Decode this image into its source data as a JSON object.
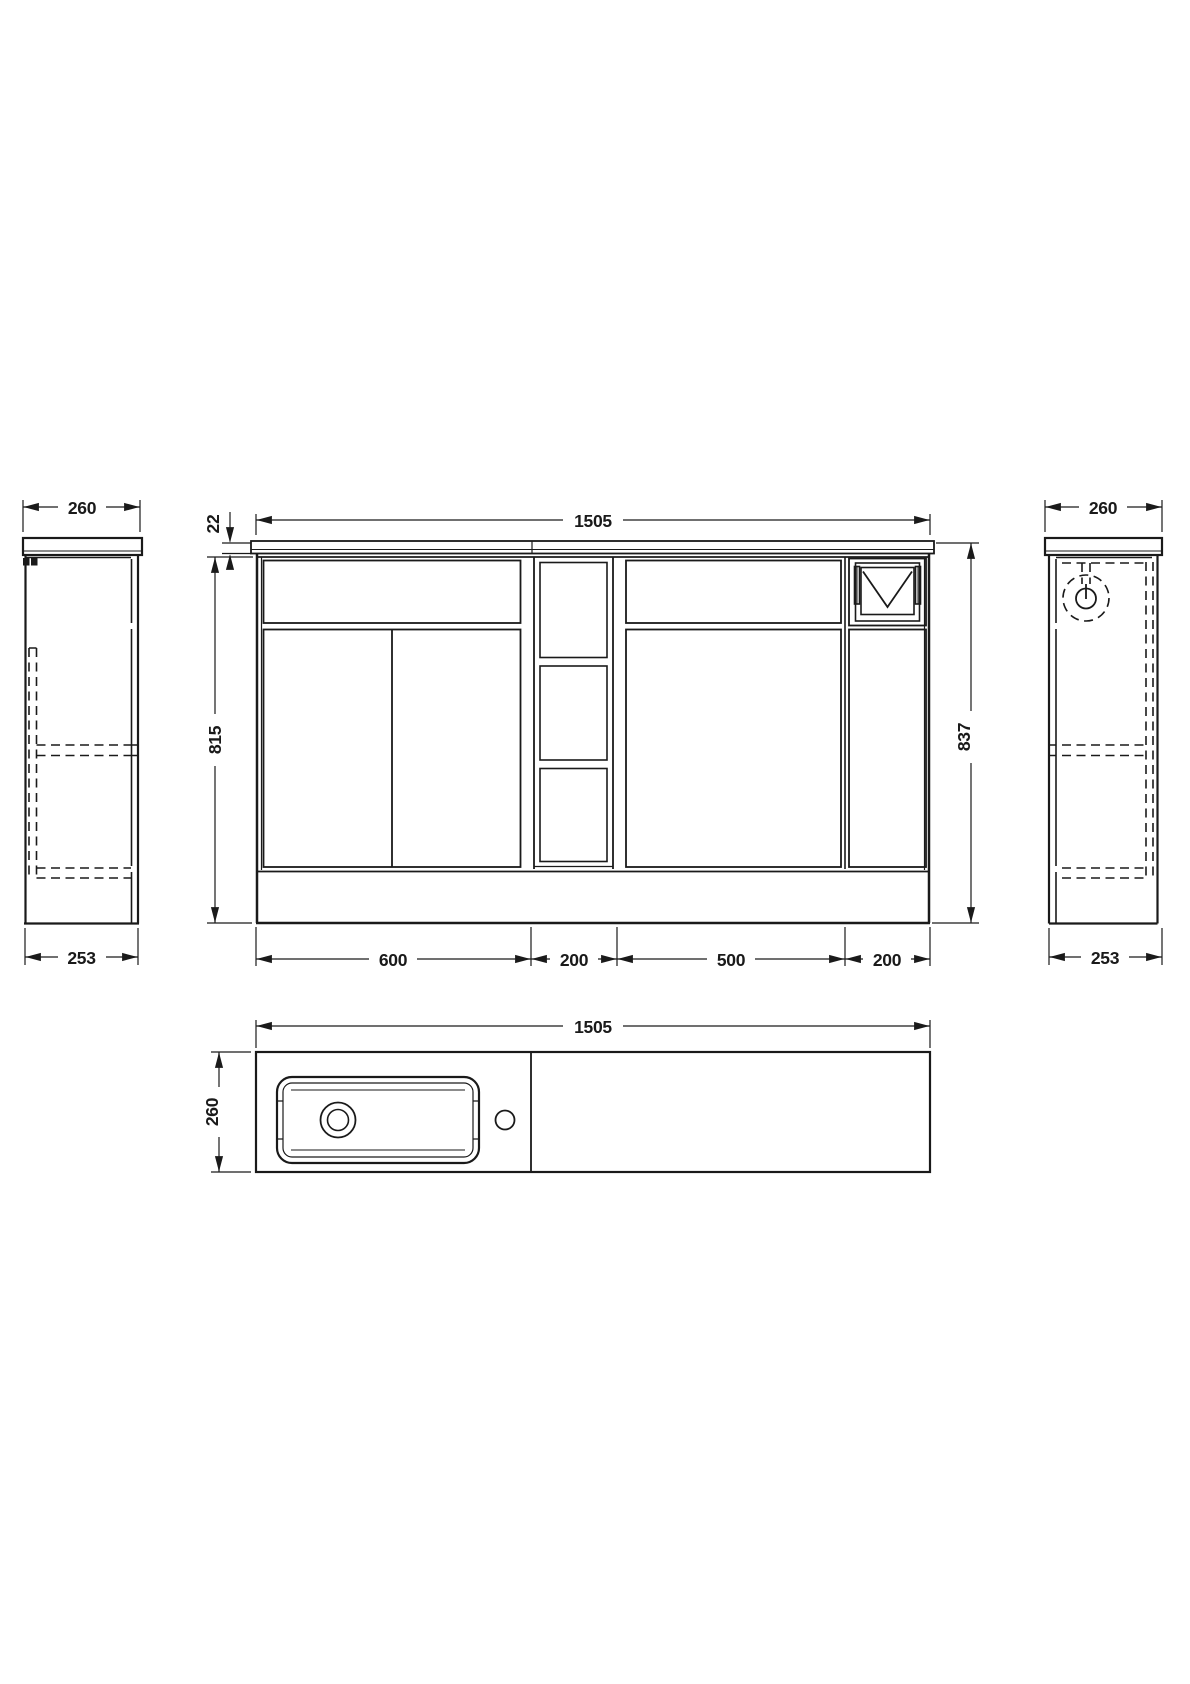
{
  "page": {
    "background": "#ffffff",
    "line_color": "#1a1a1a"
  },
  "views": {
    "left_side": {
      "width": "260",
      "depth": "253"
    },
    "front": {
      "width": "1505",
      "worktop_thickness": "22",
      "cabinet_height": "815",
      "total_height": "837",
      "segments": [
        "600",
        "200",
        "500",
        "200"
      ]
    },
    "right_side": {
      "width": "260",
      "depth": "253"
    },
    "plan": {
      "width": "1505",
      "depth": "260"
    }
  }
}
